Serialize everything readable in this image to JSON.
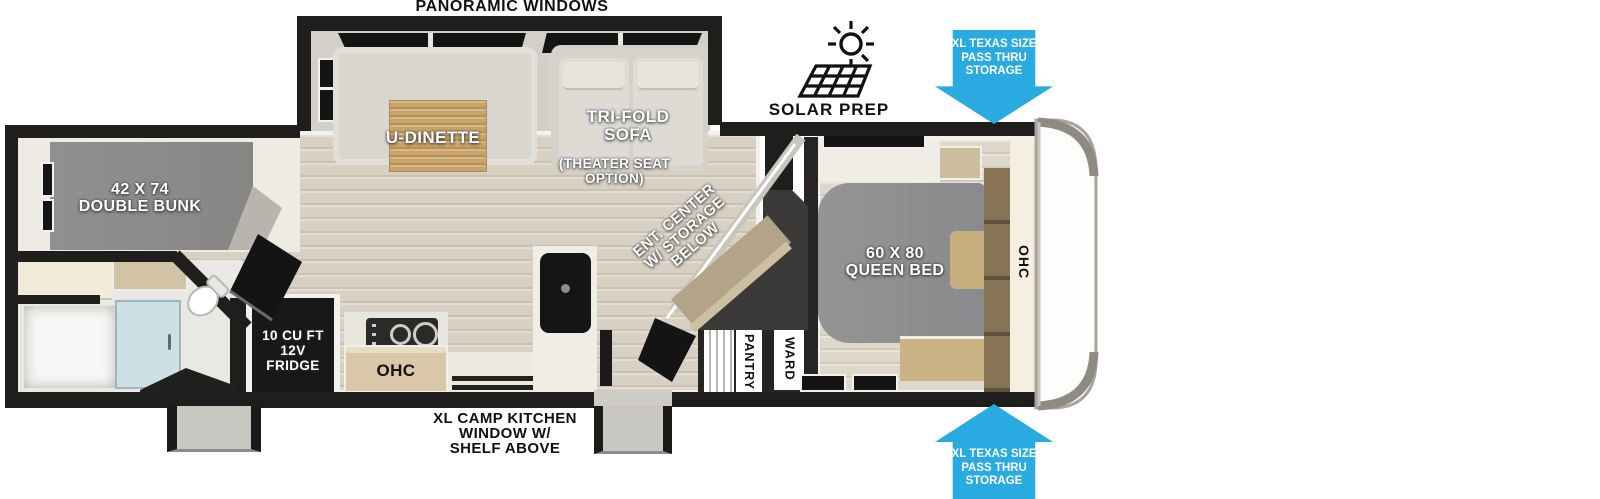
{
  "colors": {
    "arrow_blue": "#29ABE2",
    "wall_black": "#1F1E1C",
    "floor_wood": "#D8D1C3",
    "bunk_gray": "#8C8B89",
    "bed_gray": "#8F8F91",
    "table_wood": "#C9A368",
    "cabinet_tan": "#D9C7A8",
    "ent_tan": "#B3A488",
    "headboard_brown": "#877454",
    "shower_blue": "#CDE0E5",
    "step_gray": "#C9C7C2"
  },
  "labels": {
    "panoramic_windows": "PANORAMIC WINDOWS",
    "solar_prep": "SOLAR PREP",
    "pass_thru_lines": [
      "XL TEXAS SIZE",
      "PASS THRU",
      "STORAGE"
    ],
    "u_dinette": "U-DINETTE",
    "tri_fold_sofa_lines": [
      "TRI-FOLD",
      "SOFA"
    ],
    "theater_option_lines": [
      "(THEATER SEAT",
      "OPTION)"
    ],
    "double_bunk_lines": [
      "42 X 74",
      "DOUBLE BUNK"
    ],
    "queen_bed_lines": [
      "60 X 80",
      "QUEEN BED"
    ],
    "ent_center_lines": [
      "ENT. CENTER",
      "W/ STORAGE",
      "BELOW"
    ],
    "fridge_lines": [
      "10 CU FT",
      "12V",
      "FRIDGE"
    ],
    "ohc_kitchen": "OHC",
    "ohc_bedroom": "OHC",
    "pantry": "PANTRY",
    "ward": "WARD",
    "camp_kitchen_lines": [
      "XL CAMP KITCHEN",
      "WINDOW W/",
      "SHELF ABOVE"
    ]
  }
}
